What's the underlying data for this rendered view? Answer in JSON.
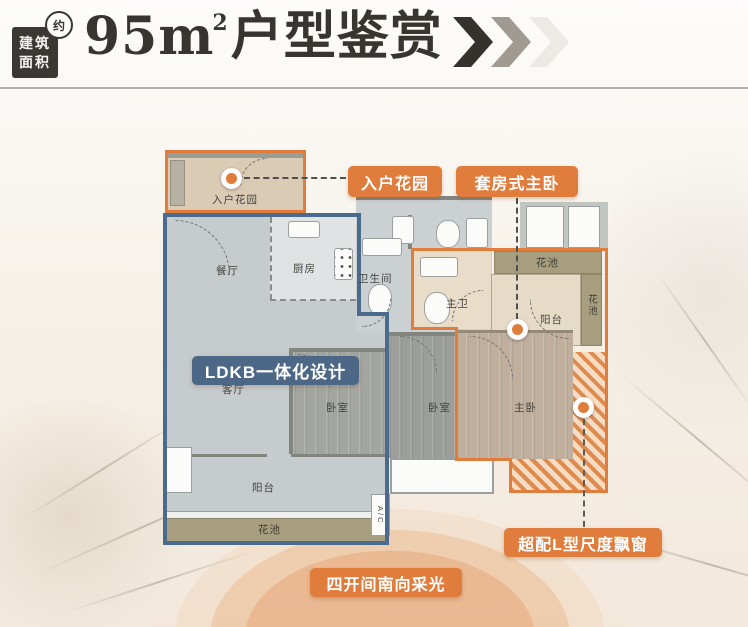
{
  "header": {
    "area_badge": {
      "line1": "建筑",
      "line2": "面积",
      "approx": "约"
    },
    "title": {
      "num": "95",
      "unit": "m",
      "sup": "2",
      "suffix": "户型鉴赏"
    }
  },
  "callouts": {
    "entry_garden": "入户花园",
    "suite_master": "套房式主卧",
    "ldkb": "LDKB一体化设计",
    "bay_window": "超配L型尺度飘窗",
    "south_light": "四开间南向采光"
  },
  "rooms": {
    "entry_garden": "入户花园",
    "dining": "餐厅",
    "kitchen": "厨房",
    "bathroom": "卫生间",
    "living": "客厅",
    "bedroom_a": "卧室",
    "bedroom_b": "卧室",
    "master_bath": "主卫",
    "master_bedroom": "主卧",
    "balcony": "阳台",
    "suite_balcony": "阳台",
    "flower_bed_top": "花池",
    "flower_bed_right": "花池",
    "flower_bed_bottom": "花池",
    "ac_unit": "A/C"
  },
  "colors": {
    "accent_orange": "#E07C3C",
    "accent_blue": "#4D6786",
    "ink": "#38342F",
    "hatch_orange": "#DE8B4F",
    "flower_olive": "#A69E7E"
  }
}
